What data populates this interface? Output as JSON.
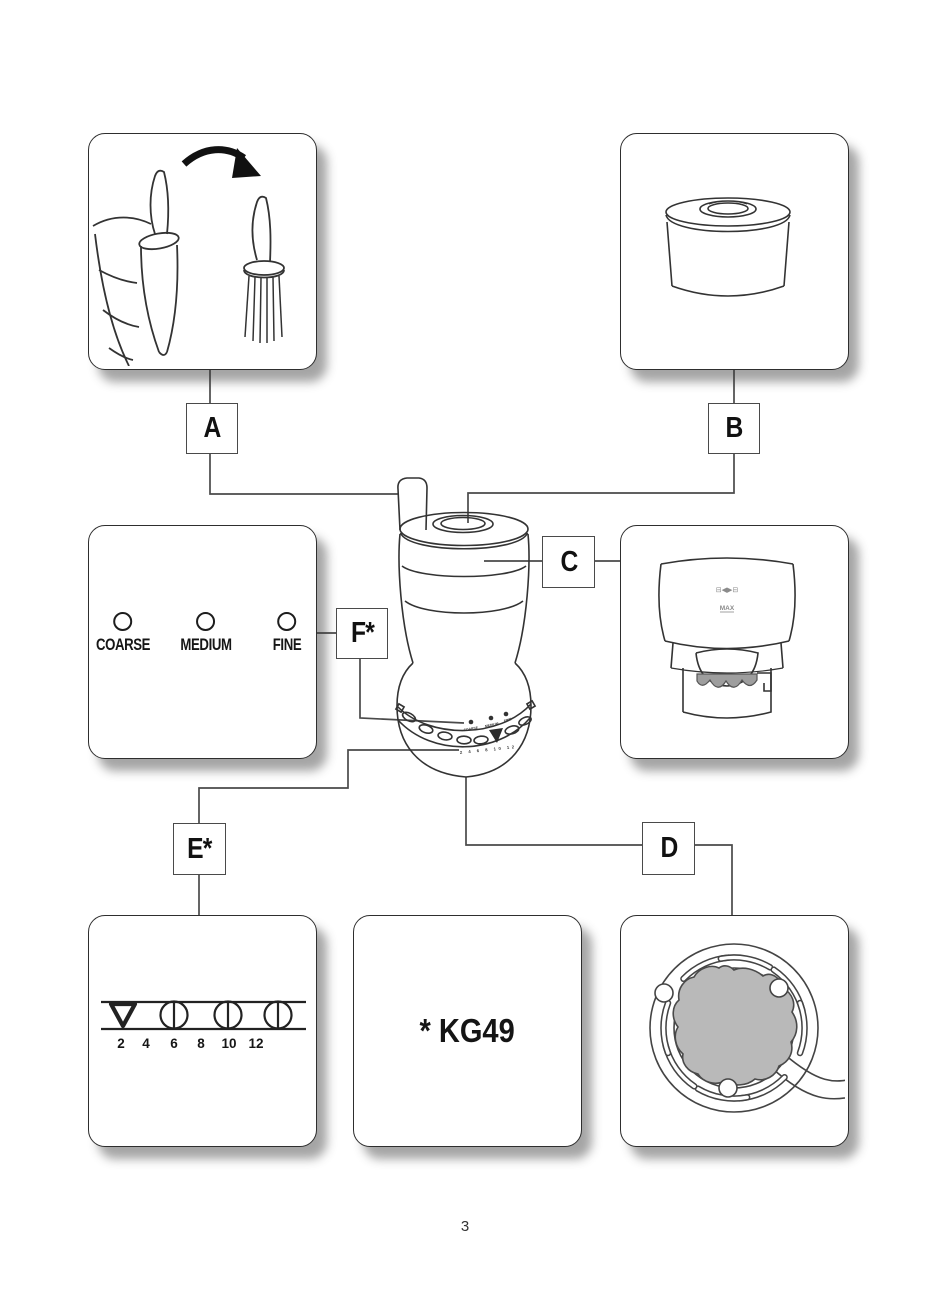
{
  "page": {
    "number": "3"
  },
  "callouts": {
    "a": {
      "label": "A"
    },
    "b": {
      "label": "B"
    },
    "c": {
      "label": "C"
    },
    "d": {
      "label": "D"
    },
    "e": {
      "label": "E*"
    },
    "f": {
      "label": "F*"
    }
  },
  "grind_settings_box": {
    "options": [
      {
        "label": "COARSE"
      },
      {
        "label": "MEDIUM"
      },
      {
        "label": "FINE"
      }
    ]
  },
  "quantity_box": {
    "numbers": [
      "2",
      "4",
      "6",
      "8",
      "10",
      "12"
    ]
  },
  "model_box": {
    "label": "* KG49"
  },
  "container_box": {
    "lock_markings": "⊟◀▶⊟",
    "max_label": "MAX"
  },
  "grinder": {
    "dial_labels": [
      "COARSE",
      "MEDIUM",
      "FINE"
    ],
    "dial_numbers": "2 4 6 8 10 12"
  }
}
